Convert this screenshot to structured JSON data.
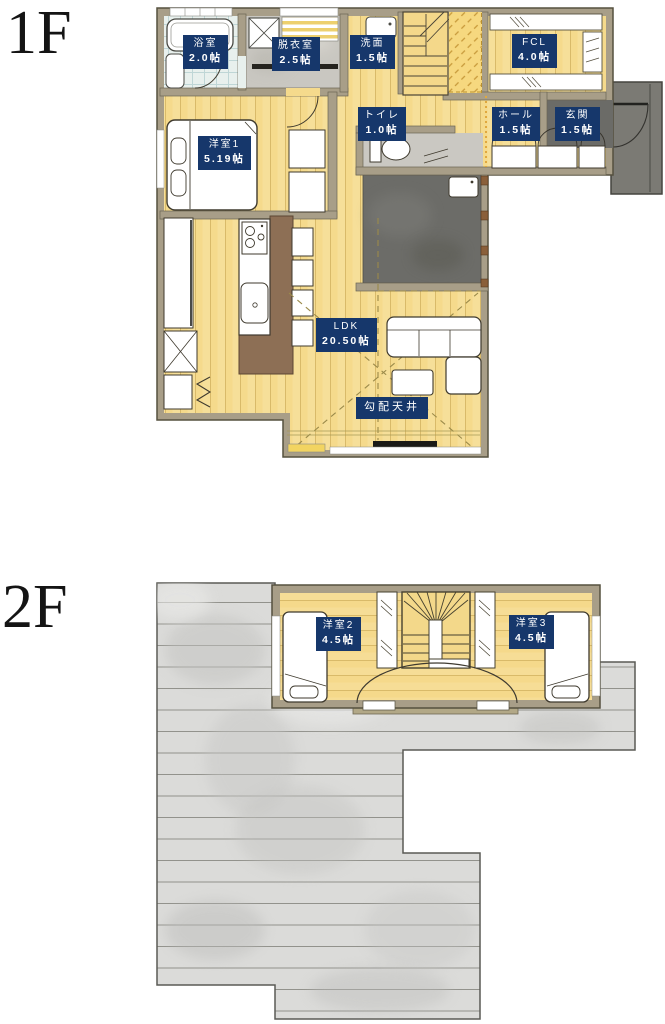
{
  "floors": [
    {
      "label": "1F",
      "rooms": [
        {
          "name": "浴室",
          "size": "2.0帖"
        },
        {
          "name": "脱衣室",
          "size": "2.5帖"
        },
        {
          "name": "洗面",
          "size": "1.5帖"
        },
        {
          "name": "FCL",
          "size": "4.0帖"
        },
        {
          "name": "トイレ",
          "size": "1.0帖"
        },
        {
          "name": "ホール",
          "size": "1.5帖"
        },
        {
          "name": "玄関",
          "size": "1.5帖"
        },
        {
          "name": "洋室1",
          "size": "5.19帖"
        },
        {
          "name": "LDK",
          "size": "20.50帖"
        }
      ],
      "annotations": [
        "勾配天井"
      ]
    },
    {
      "label": "2F",
      "rooms": [
        {
          "name": "洋室2",
          "size": "4.5帖"
        },
        {
          "name": "洋室3",
          "size": "4.5帖"
        }
      ]
    }
  ],
  "colors": {
    "label_bg": "#16376b",
    "label_text": "#ffffff",
    "wall": "#a89e88",
    "wood_floor": "#f5da8c",
    "tile_floor": "#e8f0ed",
    "gray_floor": "#c9c7c1",
    "terrace": "#6c6c68",
    "roof": "#dbdbd9",
    "counter_brown": "#8d6f55"
  }
}
